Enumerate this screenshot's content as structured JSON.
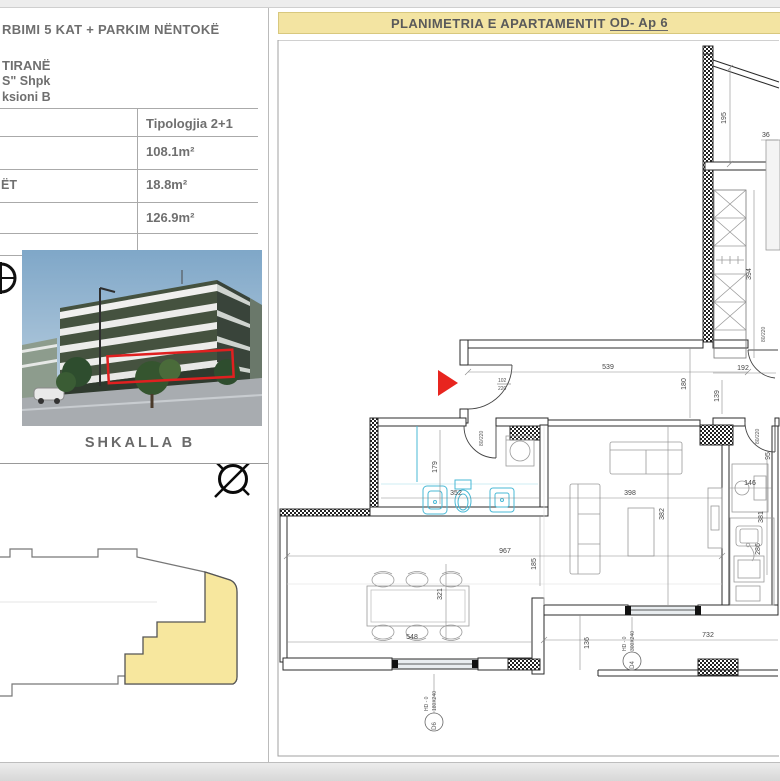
{
  "page": {
    "title_main": "PLANIMETRIA E APARTAMENTIT",
    "title_ap": "OD- Ap 6"
  },
  "left_panel": {
    "line1": "RBIMI 5 KAT + PARKIM NËNTOKË",
    "line2": "TIRANË",
    "line3": "S\" Shpk",
    "line4": "ksioni B",
    "table": {
      "header": "Tipologjia 2+1",
      "row1_value": "108.1m²",
      "row2_label": "ËT",
      "row2_value": "18.8m²",
      "row3_value": "126.9m²"
    },
    "photo_caption": "SHKALLA  B"
  },
  "plan": {
    "dims": {
      "d195": "195",
      "d36": "36",
      "d394": "394",
      "d192": "192",
      "d139": "139",
      "d539": "539",
      "d180": "180",
      "d179": "179",
      "d352": "352",
      "d398": "398",
      "d382": "382",
      "d967": "967",
      "d185": "185",
      "d321": "321",
      "d548": "548",
      "d136": "136",
      "d732": "732",
      "d146": "146",
      "d95": "95",
      "d381": "381",
      "d286": "286"
    },
    "doors": {
      "entry_w": "102",
      "entry_h": "220",
      "bath": "80/220",
      "bedroom": "80/220",
      "kitchen": "80/220"
    },
    "windows": {
      "w1": {
        "id": "D6",
        "code": "HD - 0",
        "size": "180X240"
      },
      "w2": {
        "id": "D4",
        "code": "HD - 0",
        "size": "300X240"
      }
    }
  },
  "colors": {
    "banner": "#f3e4a2",
    "accent_red": "#e8251f",
    "fixture_cyan": "#49b9d6",
    "keyplan_yellow": "#f7e79e"
  }
}
